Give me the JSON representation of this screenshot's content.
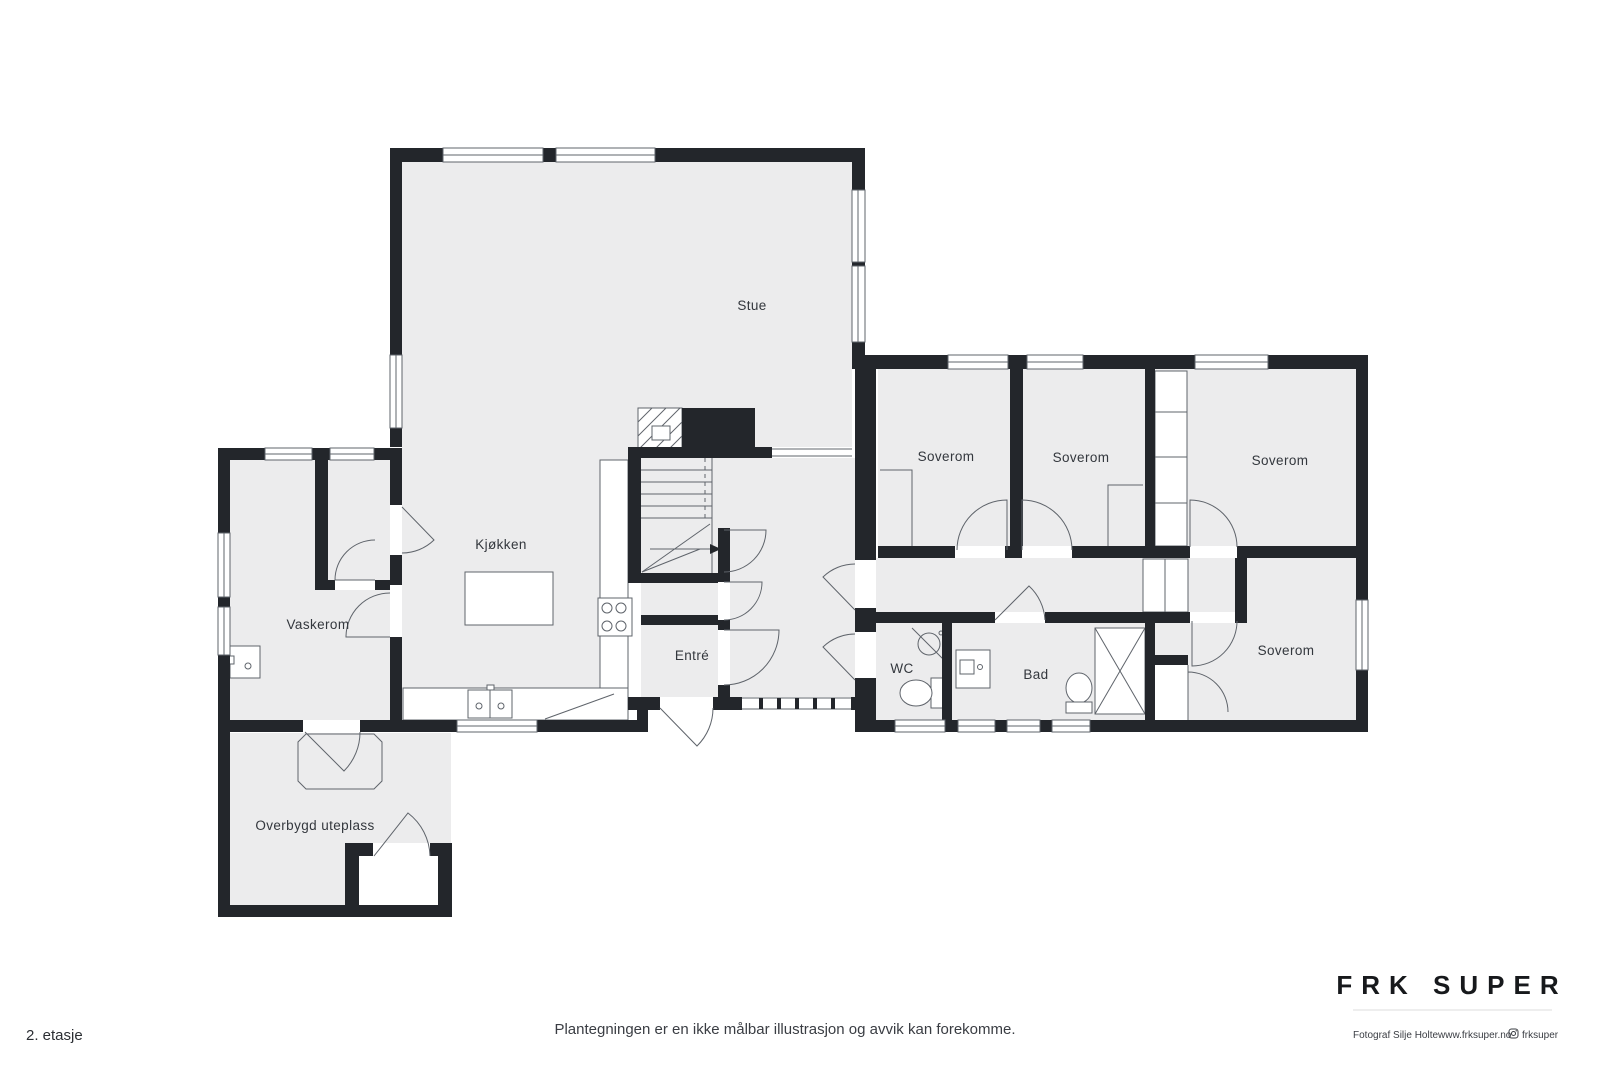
{
  "floorplan": {
    "floor_label": "2. etasje",
    "disclaimer": "Plantegningen er en ikke målbar illustrasjon og avvik kan forekomme.",
    "rooms": {
      "stue": "Stue",
      "kjokken": "Kjøkken",
      "vaskerom": "Vaskerom",
      "entre": "Entré",
      "wc": "WC",
      "bad": "Bad",
      "soverom_1": "Soverom",
      "soverom_2": "Soverom",
      "soverom_3": "Soverom",
      "soverom_4": "Soverom",
      "uteplass": "Overbygd uteplass"
    }
  },
  "branding": {
    "logo": "FRK SUPER",
    "photographer": "Fotograf Silje Holte",
    "website": "www.frksuper.no",
    "instagram": "frksuper"
  },
  "colors": {
    "wall": "#23262b",
    "floor": "#ececed",
    "thin_line": "#5f646b",
    "text": "#33373d",
    "background": "#ffffff"
  }
}
